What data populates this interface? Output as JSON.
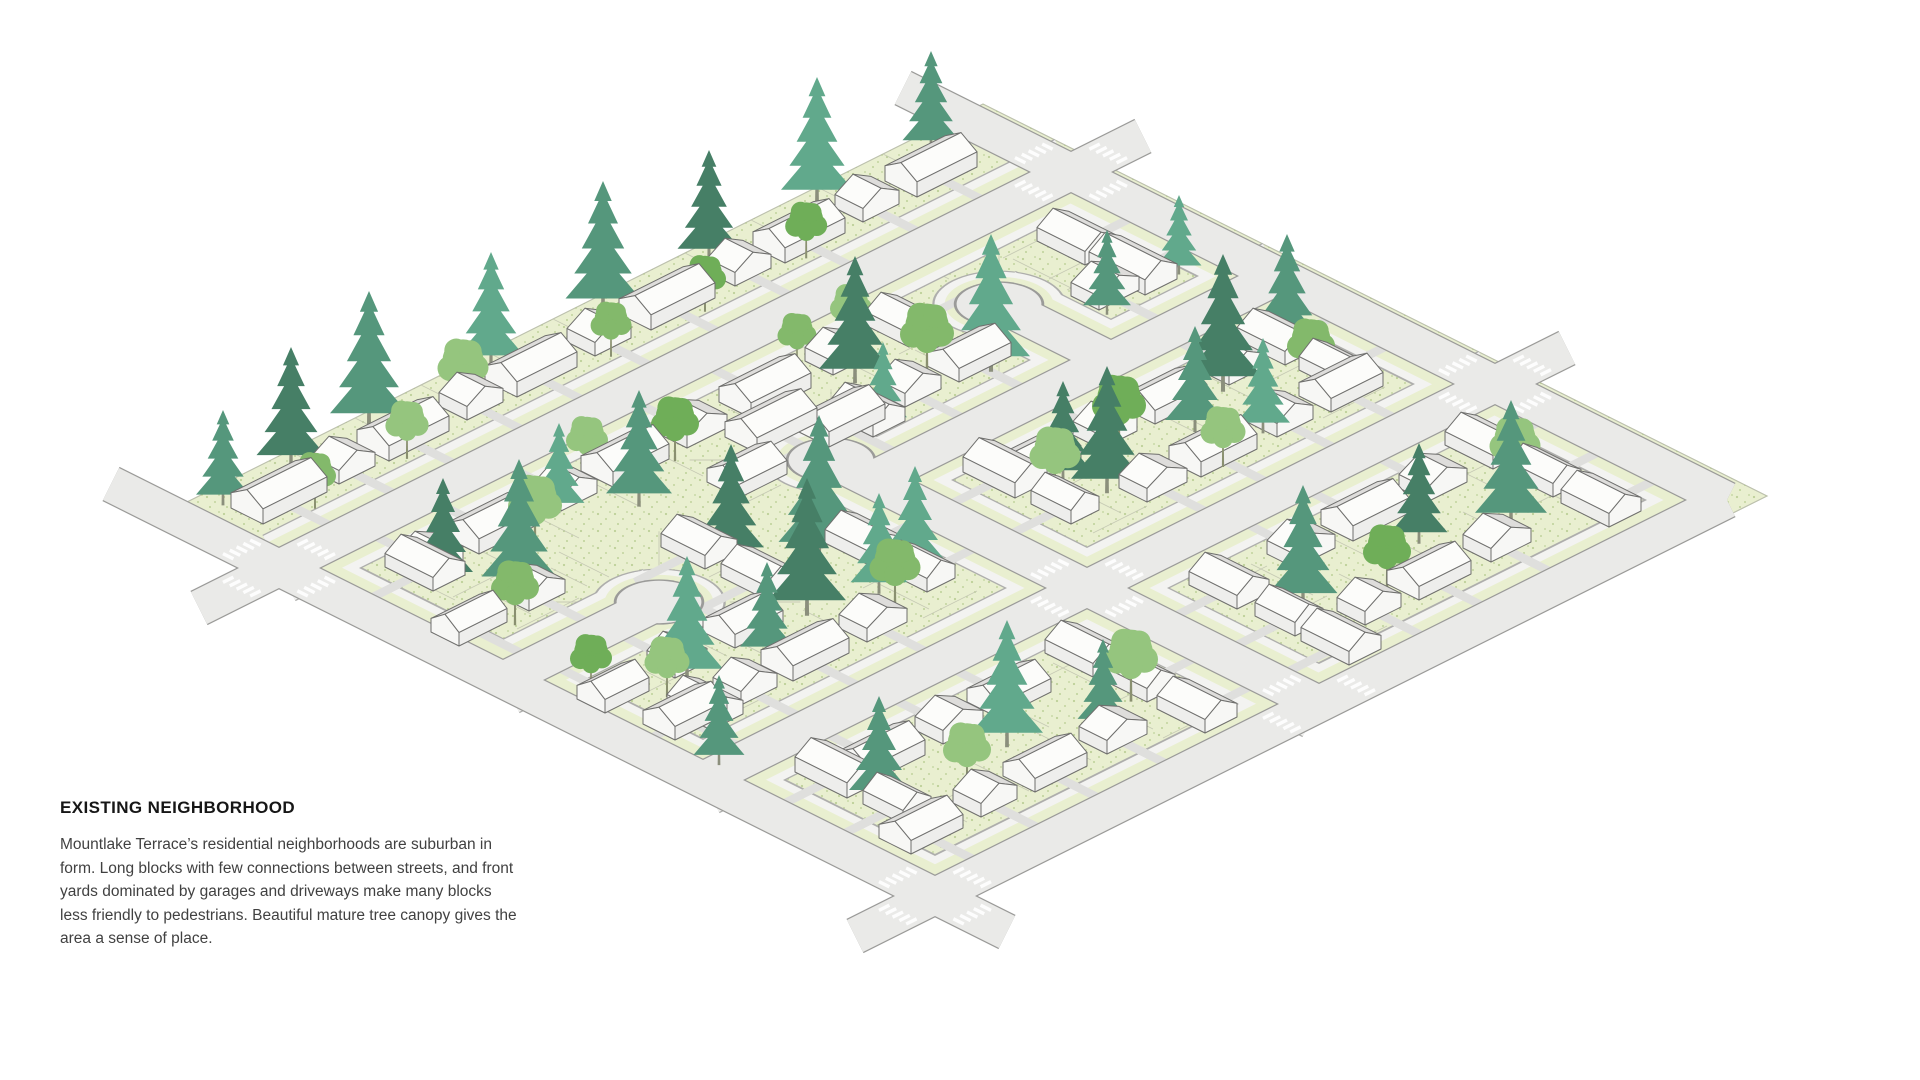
{
  "caption": {
    "title": "EXISTING NEIGHBORHOOD",
    "body": "Mountlake Terrace’s residential neighborhoods are suburban in form. Long blocks with few connections between streets, and front yards dominated by garages and driveways make many blocks less friendly to pedestrians. Beautiful mature tree canopy gives the area a sense of place."
  },
  "illustration": {
    "description": "Isometric diagram of an existing suburban neighborhood: long residential blocks, single-family houses with driveways, cul-de-sacs, crosswalked intersections and mature evergreen and deciduous tree canopy over stippled lawns",
    "colors": {
      "lawn": "#e9efd0",
      "lawnEdge": "#bcc0ad",
      "stipple": "#a8c17c",
      "lotLine": "#c3c7b2",
      "walk": "#f3f3f1",
      "walkCasing": "#aeaeac",
      "road": "#eaeae8",
      "roadCasing": "#9b9b99",
      "driveway": "#dfdfdd",
      "crosswalk": "#ffffff",
      "roofNear": "#fcfcfa",
      "roofFar": "#dedddb",
      "wall": "#eeeeec",
      "gable": "#f7f7f5",
      "houseOutline": "#6f6f6d",
      "coniferTrunk": "#8b8f7c",
      "deciduousTrunk": "#8a9070",
      "conifer": [
        "#55977c",
        "#467f66",
        "#61a98c",
        "#3a7258"
      ],
      "deciduous": [
        "#83b96b",
        "#95c57e",
        "#6fae58"
      ]
    },
    "iso": {
      "s": 40,
      "ox": 135,
      "oy": 520,
      "zf": 40
    },
    "lawn": [
      [
        0.2,
        0.2
      ],
      [
        21.0,
        0.2
      ],
      [
        21.0,
        19.8
      ],
      [
        0.2,
        19.8
      ]
    ],
    "streets": [
      {
        "pts": [
          [
            0.6,
            3
          ],
          [
            20.4,
            3
          ]
        ],
        "t": "in"
      },
      {
        "pts": [
          [
            10.2,
            8.2
          ],
          [
            20.4,
            8.2
          ]
        ],
        "t": "in"
      },
      {
        "pts": [
          [
            0.6,
            13.6
          ],
          [
            20.4,
            13.6
          ]
        ],
        "t": "in"
      },
      {
        "pts": [
          [
            10.2,
            7.2
          ],
          [
            10.2,
            19.4
          ]
        ],
        "t": "in"
      },
      {
        "pts": [
          [
            0.6,
            8.6
          ],
          [
            4.5,
            8.6
          ]
        ],
        "t": "in"
      },
      {
        "pts": [
          [
            16.2,
            5.4
          ],
          [
            16.2,
            8.2
          ]
        ],
        "t": "in"
      },
      {
        "pts": [
          [
            0.6,
            3
          ],
          [
            0.6,
            19.4
          ]
        ],
        "t": "b+u"
      },
      {
        "pts": [
          [
            20.4,
            3
          ],
          [
            20.4,
            19.4
          ]
        ],
        "t": "b-u"
      },
      {
        "pts": [
          [
            0.6,
            19.4
          ],
          [
            20.4,
            19.4
          ]
        ],
        "t": "b-v"
      },
      {
        "pts": [
          [
            0.6,
            3
          ],
          [
            -1.4,
            3
          ]
        ],
        "t": "minor"
      },
      {
        "pts": [
          [
            0.6,
            3
          ],
          [
            0.6,
            -1.2
          ]
        ],
        "t": "minor"
      },
      {
        "pts": [
          [
            20.4,
            3
          ],
          [
            22.2,
            3
          ]
        ],
        "t": "minor"
      },
      {
        "pts": [
          [
            20.4,
            3
          ],
          [
            20.4,
            -1.2
          ]
        ],
        "t": "minor"
      },
      {
        "pts": [
          [
            20.4,
            13.6
          ],
          [
            22.2,
            13.6
          ]
        ],
        "t": "minor"
      },
      {
        "pts": [
          [
            0.6,
            19.4
          ],
          [
            -1.4,
            19.4
          ]
        ],
        "t": "minor"
      },
      {
        "pts": [
          [
            0.6,
            19.4
          ],
          [
            0.6,
            21.2
          ]
        ],
        "t": "minor"
      }
    ],
    "bulbs": [
      [
        10.2,
        7.2
      ],
      [
        4.5,
        8.6
      ],
      [
        16.2,
        5.4
      ]
    ],
    "crosswalks": [
      [
        0.6,
        3
      ],
      [
        20.4,
        3
      ],
      [
        10.2,
        13.6
      ],
      [
        20.4,
        13.6
      ],
      [
        0.6,
        19.4
      ],
      [
        10.2,
        19.4
      ]
    ],
    "lots": [
      [
        "u",
        3,
        -1,
        2.0,
        19.8,
        1.65,
        1.45,
        2.8
      ],
      [
        "u",
        3,
        1,
        2.0,
        19.8,
        1.55,
        1.45,
        3.0
      ],
      [
        "u",
        8.2,
        -1,
        10.8,
        19.9,
        1.6,
        1.45,
        2.7
      ],
      [
        "u",
        8.2,
        1,
        10.8,
        19.9,
        1.55,
        1.45,
        3.0
      ],
      [
        "u",
        13.6,
        -1,
        1.3,
        19.9,
        1.6,
        1.45,
        3.0
      ],
      [
        "u",
        13.6,
        1,
        1.3,
        19.9,
        1.65,
        1.45,
        3.0
      ],
      [
        "u",
        19.4,
        -1,
        1.3,
        19.9,
        1.55,
        1.45,
        3.0
      ],
      [
        "v",
        0.6,
        1,
        4.3,
        18.8,
        1.6,
        1.45,
        3.0
      ],
      [
        "v",
        20.4,
        -1,
        4.3,
        18.8,
        1.6,
        1.45,
        3.0
      ],
      [
        "v",
        10.2,
        -1,
        9.3,
        18.9,
        1.5,
        1.45,
        2.8
      ],
      [
        "v",
        10.2,
        1,
        9.3,
        18.9,
        1.5,
        1.45,
        2.8
      ],
      [
        "u",
        8.6,
        -1,
        1.2,
        4.0,
        1.4,
        1.3,
        2.2
      ],
      [
        "u",
        8.6,
        1,
        1.2,
        4.0,
        1.4,
        1.3,
        2.2
      ],
      [
        "v",
        16.2,
        -1,
        6.2,
        7.9,
        1.2,
        1.25,
        2.3
      ],
      [
        "v",
        16.2,
        1,
        6.2,
        7.9,
        1.2,
        1.25,
        2.3
      ]
    ],
    "houses": [
      [
        2.3,
        1.3,
        1.6,
        0.8,
        0,
        1
      ],
      [
        3.9,
        1.3,
        0.9,
        0.7,
        1,
        1
      ],
      [
        5.4,
        1.3,
        1.5,
        0.8,
        0,
        1
      ],
      [
        7.1,
        1.3,
        0.9,
        0.7,
        1,
        1
      ],
      [
        8.6,
        1.3,
        1.5,
        0.8,
        0,
        1
      ],
      [
        10.3,
        1.3,
        0.9,
        0.7,
        1,
        1
      ],
      [
        12.0,
        1.3,
        1.6,
        0.8,
        0,
        1
      ],
      [
        13.8,
        1.3,
        0.9,
        0.7,
        1,
        1
      ],
      [
        15.3,
        1.3,
        1.5,
        0.8,
        0,
        1
      ],
      [
        17.0,
        1.3,
        0.9,
        0.7,
        1,
        1
      ],
      [
        18.6,
        1.3,
        1.5,
        0.8,
        0,
        1
      ],
      [
        2.6,
        4.75,
        1.0,
        0.7,
        1,
        2
      ],
      [
        4.2,
        4.75,
        1.5,
        0.8,
        0,
        2
      ],
      [
        6.0,
        4.75,
        0.9,
        0.7,
        1,
        2
      ],
      [
        7.5,
        4.75,
        1.4,
        0.8,
        0,
        2
      ],
      [
        9.2,
        4.75,
        1.0,
        0.7,
        1,
        2
      ],
      [
        11.0,
        4.75,
        1.5,
        0.8,
        0,
        2
      ],
      [
        12.8,
        4.75,
        0.9,
        0.7,
        1,
        2
      ],
      [
        14.4,
        4.8,
        0.8,
        1.1,
        1,
        3
      ],
      [
        11.2,
        6.45,
        1.4,
        0.8,
        0,
        1
      ],
      [
        12.9,
        6.45,
        0.9,
        0.7,
        1,
        1
      ],
      [
        14.4,
        6.45,
        1.3,
        0.8,
        0,
        1
      ],
      [
        17.8,
        6.45,
        1.0,
        0.7,
        1,
        1
      ],
      [
        12.6,
        9.95,
        1.4,
        0.8,
        0,
        2
      ],
      [
        14.3,
        9.95,
        0.9,
        0.7,
        1,
        2
      ],
      [
        15.8,
        9.95,
        1.3,
        0.8,
        0,
        2
      ],
      [
        17.5,
        9.95,
        0.9,
        0.7,
        1,
        2
      ],
      [
        1.9,
        11.85,
        1.3,
        0.8,
        0,
        1
      ],
      [
        3.4,
        11.85,
        0.9,
        0.7,
        1,
        1
      ],
      [
        4.9,
        11.85,
        1.4,
        0.8,
        0,
        1
      ],
      [
        6.6,
        11.85,
        1.0,
        0.7,
        1,
        1
      ],
      [
        13.6,
        11.85,
        1.0,
        0.7,
        1,
        1
      ],
      [
        15.1,
        11.85,
        1.4,
        0.8,
        0,
        1
      ],
      [
        16.8,
        11.85,
        0.9,
        0.7,
        1,
        1
      ],
      [
        18.3,
        11.85,
        1.3,
        0.8,
        0,
        1
      ],
      [
        3.3,
        15.35,
        1.4,
        0.8,
        0,
        2
      ],
      [
        5.0,
        15.35,
        1.0,
        0.7,
        1,
        2
      ],
      [
        6.5,
        15.35,
        1.3,
        0.8,
        0,
        2
      ],
      [
        13.8,
        15.35,
        1.0,
        0.7,
        1,
        2
      ],
      [
        15.4,
        15.35,
        1.4,
        0.8,
        0,
        2
      ],
      [
        17.1,
        15.35,
        1.0,
        0.7,
        1,
        2
      ],
      [
        2.0,
        17.65,
        1.3,
        0.8,
        0,
        1
      ],
      [
        3.6,
        17.65,
        0.9,
        0.7,
        1,
        1
      ],
      [
        5.1,
        17.65,
        1.3,
        0.8,
        0,
        1
      ],
      [
        6.8,
        17.65,
        1.0,
        0.7,
        1,
        1
      ],
      [
        13.2,
        17.65,
        0.9,
        0.7,
        1,
        1
      ],
      [
        14.7,
        17.65,
        1.3,
        0.8,
        0,
        1
      ],
      [
        16.4,
        17.65,
        1.0,
        0.7,
        1,
        1
      ],
      [
        2.35,
        4.9,
        0.8,
        1.2,
        1,
        4
      ],
      [
        2.35,
        11.9,
        0.8,
        1.1,
        1,
        4
      ],
      [
        2.35,
        15.2,
        0.8,
        1.3,
        1,
        4
      ],
      [
        2.35,
        16.7,
        0.7,
        1.0,
        1,
        4
      ],
      [
        18.65,
        4.9,
        0.8,
        1.2,
        1,
        3
      ],
      [
        18.65,
        6.3,
        0.8,
        1.4,
        1,
        3
      ],
      [
        18.65,
        9.9,
        0.8,
        1.2,
        1,
        3
      ],
      [
        18.65,
        11.3,
        0.7,
        1.0,
        1,
        3
      ],
      [
        18.65,
        15.1,
        0.8,
        1.2,
        1,
        3
      ],
      [
        18.65,
        16.6,
        0.7,
        1.1,
        1,
        3
      ],
      [
        18.65,
        18.0,
        0.8,
        1.2,
        1,
        3
      ],
      [
        8.45,
        9.8,
        0.8,
        1.2,
        1,
        3
      ],
      [
        8.45,
        11.2,
        0.7,
        1.0,
        1,
        3
      ],
      [
        8.45,
        15.3,
        0.8,
        1.2,
        1,
        3
      ],
      [
        8.45,
        16.7,
        0.7,
        1.0,
        1,
        3
      ],
      [
        8.45,
        18.1,
        0.8,
        1.2,
        1,
        3
      ],
      [
        11.95,
        9.8,
        0.8,
        1.3,
        1,
        4
      ],
      [
        11.95,
        11.3,
        0.7,
        1.0,
        1,
        4
      ],
      [
        11.95,
        15.4,
        0.8,
        1.2,
        1,
        4
      ],
      [
        11.95,
        16.9,
        0.7,
        1.0,
        1,
        4
      ],
      [
        11.95,
        18.2,
        0.8,
        1.2,
        1,
        4
      ],
      [
        8.7,
        6.6,
        1.2,
        0.8,
        0,
        3
      ],
      [
        10.2,
        5.7,
        1.5,
        0.8,
        0,
        1
      ],
      [
        11.7,
        6.6,
        0.8,
        1.1,
        1,
        4
      ],
      [
        1.5,
        6.85,
        1.2,
        0.7,
        0,
        1
      ],
      [
        3.1,
        6.85,
        0.9,
        0.7,
        1,
        1
      ],
      [
        1.6,
        10.35,
        1.1,
        0.7,
        0,
        2
      ],
      [
        3.2,
        10.35,
        0.8,
        0.7,
        1,
        2
      ],
      [
        6.3,
        7.8,
        0.8,
        1.1,
        1,
        4
      ],
      [
        6.3,
        9.3,
        0.8,
        1.1,
        1,
        4
      ],
      [
        4.9,
        10.3,
        1.2,
        0.8,
        0,
        2
      ]
    ],
    "trees": [
      [
        1.6,
        0.6,
        0,
        0.9,
        0
      ],
      [
        3.4,
        0.5,
        0,
        1.15,
        1
      ],
      [
        5.4,
        0.45,
        0,
        1.3,
        0
      ],
      [
        7.0,
        1.2,
        1,
        0.85,
        1
      ],
      [
        8.4,
        0.5,
        0,
        1.1,
        2
      ],
      [
        11.2,
        0.5,
        0,
        1.25,
        0
      ],
      [
        13.8,
        0.55,
        0,
        1.05,
        1
      ],
      [
        16.6,
        0.45,
        0,
        1.2,
        2
      ],
      [
        19.3,
        0.6,
        0,
        0.95,
        0
      ],
      [
        2.6,
        1.9,
        1,
        0.7,
        0
      ],
      [
        12.4,
        1.85,
        1,
        0.7,
        2
      ],
      [
        5.0,
        1.8,
        1,
        0.72,
        1
      ],
      [
        10.1,
        1.8,
        1,
        0.68,
        0
      ],
      [
        15.0,
        1.78,
        1,
        0.7,
        2
      ],
      [
        6.9,
        4.4,
        1,
        0.7,
        1
      ],
      [
        12.2,
        4.35,
        1,
        0.65,
        0
      ],
      [
        2.4,
        5.3,
        0,
        1.0,
        1
      ],
      [
        3.2,
        6.4,
        0,
        1.25,
        0
      ],
      [
        2.2,
        7.3,
        1,
        0.8,
        0
      ],
      [
        4.4,
        5.6,
        1,
        0.9,
        1
      ],
      [
        5.6,
        5.0,
        0,
        0.85,
        2
      ],
      [
        6.8,
        5.8,
        0,
        1.1,
        0
      ],
      [
        8.3,
        5.2,
        1,
        0.8,
        2
      ],
      [
        3.0,
        10.8,
        0,
        1.2,
        2
      ],
      [
        2.3,
        11.0,
        1,
        0.75,
        1
      ],
      [
        4.6,
        11.2,
        0,
        0.9,
        0
      ],
      [
        6.2,
        10.6,
        0,
        1.3,
        1
      ],
      [
        7.4,
        11.6,
        1,
        0.85,
        0
      ],
      [
        8.6,
        10.9,
        0,
        1.0,
        2
      ],
      [
        7.8,
        9.3,
        0,
        1.35,
        0
      ],
      [
        6.6,
        8.3,
        0,
        1.1,
        1
      ],
      [
        7.6,
        11.0,
        0,
        0.95,
        2
      ],
      [
        12.6,
        5.4,
        0,
        1.2,
        1
      ],
      [
        13.6,
        6.2,
        1,
        0.9,
        0
      ],
      [
        11.8,
        6.9,
        0,
        0.8,
        2
      ],
      [
        14.6,
        6.8,
        0,
        1.3,
        2
      ],
      [
        13.5,
        4.4,
        1,
        0.7,
        1
      ],
      [
        12.7,
        10.5,
        0,
        0.95,
        1
      ],
      [
        12.2,
        10.8,
        1,
        0.85,
        1
      ],
      [
        13.0,
        11.3,
        0,
        1.2,
        1
      ],
      [
        14.2,
        10.4,
        1,
        0.9,
        2
      ],
      [
        15.6,
        10.9,
        0,
        1.0,
        0
      ],
      [
        17.0,
        10.2,
        0,
        1.3,
        1
      ],
      [
        18.2,
        11.2,
        1,
        0.8,
        0
      ],
      [
        16.4,
        11.8,
        0,
        0.9,
        2
      ],
      [
        18.8,
        10.0,
        0,
        1.1,
        0
      ],
      [
        15.0,
        12.2,
        1,
        0.75,
        1
      ],
      [
        17.4,
        6.9,
        0,
        0.8,
        0
      ],
      [
        19.3,
        6.8,
        0,
        0.75,
        2
      ],
      [
        2.4,
        16.2,
        0,
        1.0,
        0
      ],
      [
        3.8,
        17.0,
        1,
        0.8,
        1
      ],
      [
        5.4,
        16.4,
        0,
        1.2,
        2
      ],
      [
        7.0,
        17.2,
        0,
        0.85,
        0
      ],
      [
        8.0,
        16.9,
        1,
        0.9,
        1
      ],
      [
        12.6,
        16.6,
        0,
        1.15,
        0
      ],
      [
        14.0,
        17.3,
        1,
        0.8,
        2
      ],
      [
        15.6,
        16.5,
        0,
        0.95,
        1
      ],
      [
        17.2,
        17.2,
        0,
        1.2,
        0
      ],
      [
        18.2,
        16.3,
        1,
        0.85,
        1
      ],
      [
        1.3,
        13.3,
        0,
        0.85,
        0
      ],
      [
        1.5,
        9.9,
        1,
        0.7,
        2
      ]
    ]
  }
}
